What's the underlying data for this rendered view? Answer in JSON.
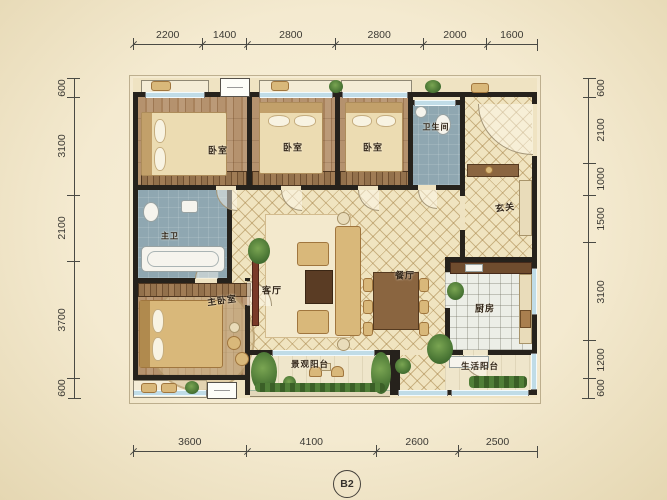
{
  "plan": {
    "code": "B2",
    "rooms": {
      "bedroom1": "卧室",
      "bedroom2": "卧室",
      "bedroom3": "卧室",
      "bathroom": "卫生间",
      "foyer": "玄关",
      "master_bath": "主卫",
      "master_bedroom": "主卧室",
      "living_room": "客厅",
      "dining_room": "餐厅",
      "kitchen": "厨房",
      "view_balcony": "景观阳台",
      "service_balcony": "生活阳台"
    },
    "dimensions": {
      "top": [
        2200,
        1400,
        2800,
        2800,
        2000,
        1600
      ],
      "bottom": [
        3600,
        4100,
        2600,
        2500
      ],
      "left": [
        600,
        3100,
        2100,
        3700,
        600
      ],
      "right": [
        600,
        2100,
        1000,
        1500,
        3100,
        1200,
        600
      ]
    },
    "colors": {
      "paper": "#f6edd2",
      "wall": "#26221c",
      "wood_floor": "#b0906c",
      "tile_floor": "#f0e4c0",
      "bath_floor": "#8fa7b1",
      "kitchen_floor": "#eceee7",
      "window": "#8fbdd2",
      "gold": "#d9b87a"
    }
  }
}
